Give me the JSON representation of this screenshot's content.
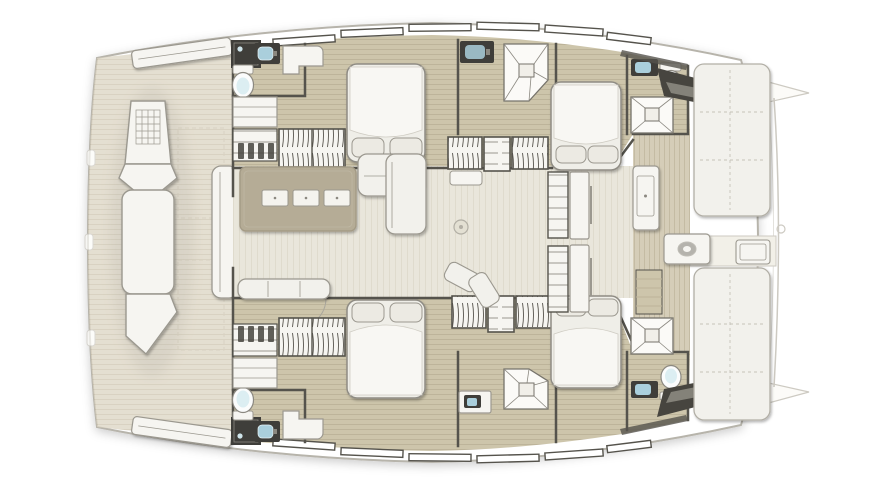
{
  "palette": {
    "page_bg": "#ffffff",
    "hull_fill": "#ffffff",
    "hull_stroke": "#b7b4ab",
    "foredeck_fill": "#dbd3c0",
    "foredeck_line": "#cbc2ab",
    "hull_floor_fill": "#cdc5ab",
    "hull_floor_line": "#bdb49a",
    "saloon_floor_fill": "#e9e6db",
    "saloon_floor_line": "#dfdbcd",
    "cockpit_floor_fill": "#d5cdb8",
    "cockpit_floor_line": "#c4bba3",
    "wall": "#55534c",
    "furniture_fill": "#f6f5f1",
    "furniture_stroke": "#9b988f",
    "cushion_fill": "#f2f1ec",
    "bed_fill": "#efeee8",
    "bed_stroke": "#8f8c84",
    "blanket_fill": "#f8f7f3",
    "pillow_fill": "#eceae3",
    "dark_fixture": "#3f3e3a",
    "dark_fixture_inner": "#8b8880",
    "sink_basin": "#aacfdc",
    "toilet_bowl_inner": "#dceef2",
    "tabletop_fill": "#b5ac96",
    "tabletop_stroke": "#a49b86",
    "drawer_fill": "#f4f3ee",
    "steps_dark": "#47453f",
    "shower_stroke": "#76736b",
    "ghost_fill": "#fcfbf8",
    "ghost_stroke": "#cdcac2",
    "door_arc": "#a9a69c",
    "hanger_line": "#57544d",
    "shadow_color": "#6b675e"
  },
  "plan": {
    "vessel": "catamaran-deck-floorplan",
    "orientation": {
      "bow": "left",
      "stern": "right",
      "starboard_hull": "top",
      "port_hull": "bottom"
    },
    "areas": [
      "foredeck-lounge",
      "forward-cockpit-bench",
      "saloon",
      "forward-head-starboard",
      "forward-cabin-starboard",
      "midship-bath-starboard",
      "aft-cabin-starboard",
      "aft-head-starboard",
      "forward-head-port",
      "forward-cabin-port",
      "midship-bath-port",
      "aft-cabin-port",
      "aft-head-port",
      "cockpit",
      "stern-bench-sunpads",
      "stern-platform"
    ],
    "fixture_counts": {
      "double_beds": 4,
      "toilets": 4,
      "shower_stalls": 6,
      "sinks": 6,
      "wardrobe_units": 6,
      "saloon_tables": 1,
      "cockpit_tables": 1,
      "stern_sun_pads": 2
    }
  }
}
